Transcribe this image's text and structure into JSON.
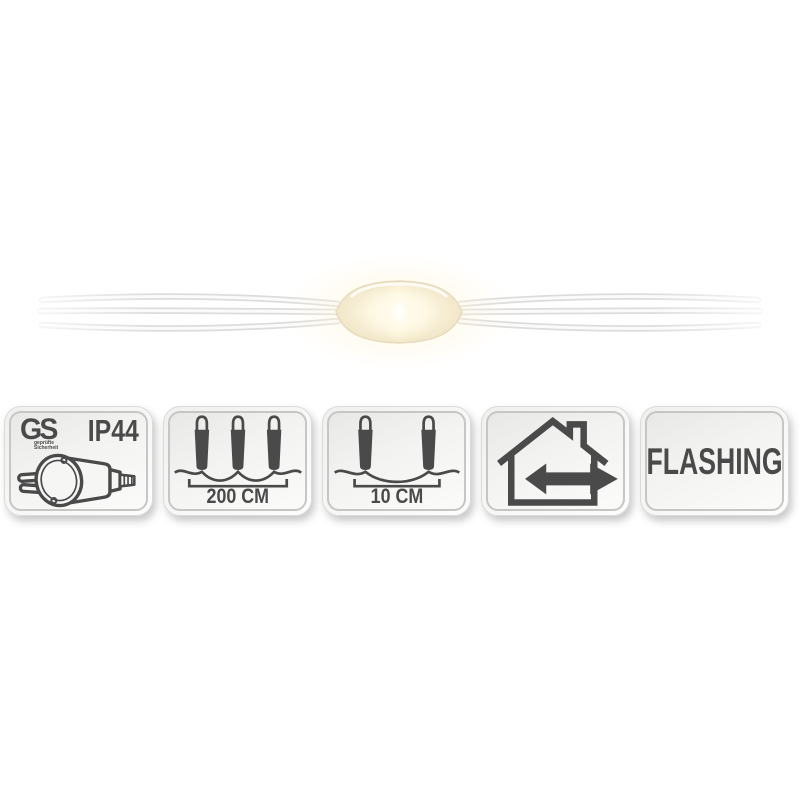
{
  "product_image": {
    "description": "micro LED string light on transparent wire, one lit warm-white LED capsule",
    "led_glow_color": "#fff4d8",
    "capsule_color": "#f2e9d2",
    "wire_color": "#dedede"
  },
  "badges": {
    "certification": {
      "logo": "GS",
      "logo_subtext_line1": "geprüfte",
      "logo_subtext_line2": "Sicherheit",
      "protection_rating": "IP44",
      "icon": "power-plug-icon"
    },
    "total_length": {
      "value": "200 CM",
      "icon": "three-bulbs-on-wire-icon"
    },
    "bulb_distance": {
      "value": "10 CM",
      "icon": "two-bulbs-on-wire-icon"
    },
    "usage": {
      "icon": "house-indoor-outdoor-arrow-icon"
    },
    "light_mode": {
      "label": "FLASHING"
    }
  },
  "colors": {
    "icon_ink": "#4a4a4a",
    "badge_inner_border": "#c6c6c5",
    "badge_background_top": "#e8e8e7",
    "badge_background_bottom": "#fbfbfa",
    "page_background": "#ffffff"
  }
}
